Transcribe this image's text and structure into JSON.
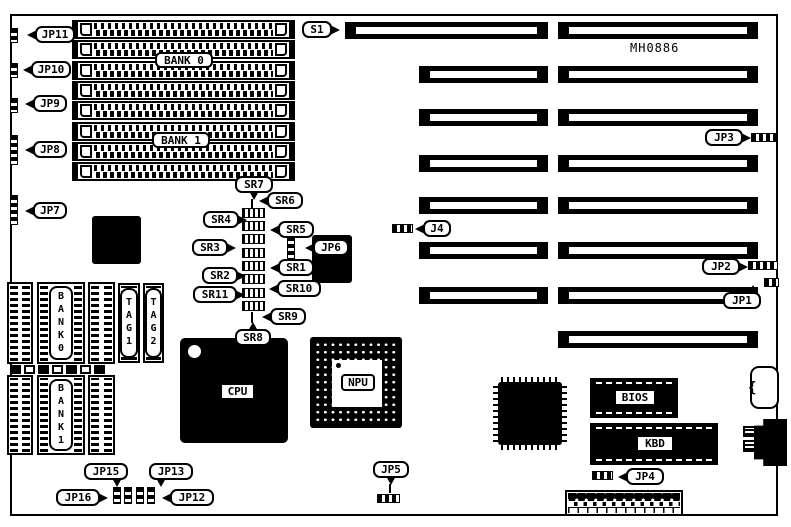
{
  "diagram": {
    "model": "MH0886",
    "memory": {
      "bank0_label": "BANK 0",
      "bank1_label": "BANK 1"
    },
    "cache": {
      "bank0": "BANK0",
      "bank1": "BANK1",
      "tag1": "TAG1",
      "tag2": "TAG2"
    },
    "chips": {
      "cpu": "CPU",
      "npu": "NPU",
      "bios": "BIOS",
      "kbd": "KBD"
    },
    "callouts": {
      "s1": "S1",
      "j4": "J4",
      "jp1": "JP1",
      "jp2": "JP2",
      "jp3": "JP3",
      "jp4": "JP4",
      "jp5": "JP5",
      "jp6": "JP6",
      "jp7": "JP7",
      "jp8": "JP8",
      "jp9": "JP9",
      "jp10": "JP10",
      "jp11": "JP11",
      "jp12": "JP12",
      "jp13": "JP13",
      "jp15": "JP15",
      "jp16": "JP16",
      "sr1": "SR1",
      "sr2": "SR2",
      "sr3": "SR3",
      "sr4": "SR4",
      "sr5": "SR5",
      "sr6": "SR6",
      "sr7": "SR7",
      "sr8": "SR8",
      "sr9": "SR9",
      "sr10": "SR10",
      "sr11": "SR11"
    }
  }
}
